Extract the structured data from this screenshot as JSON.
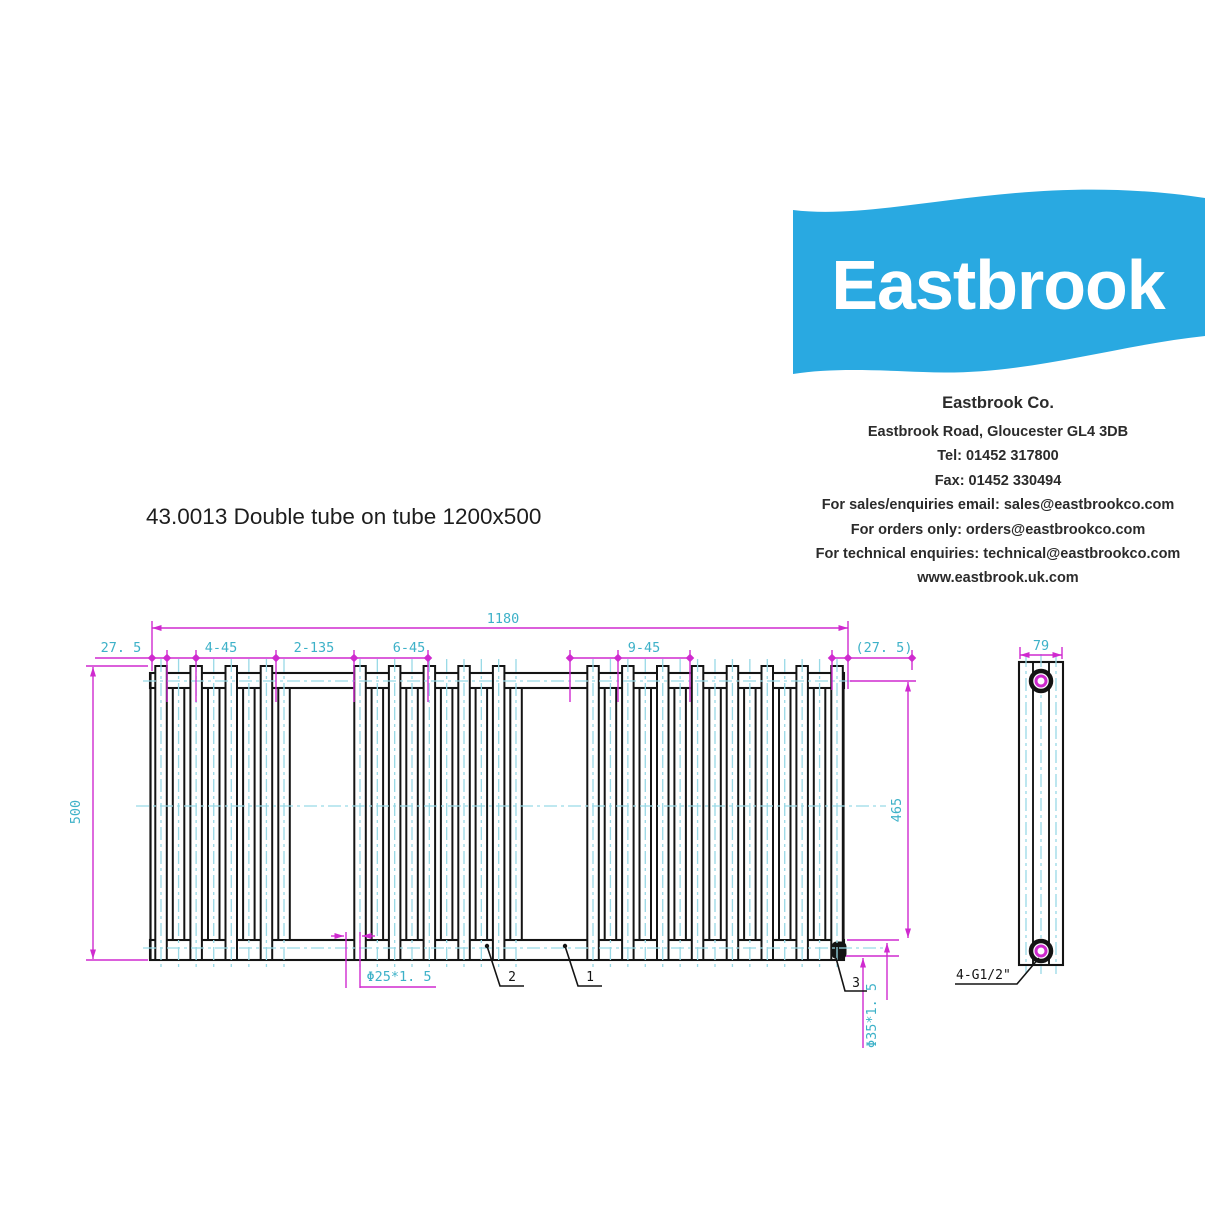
{
  "logo": {
    "text": "Eastbrook",
    "bg_color": "#29a9e1",
    "text_color": "#ffffff"
  },
  "company": {
    "name": "Eastbrook Co.",
    "lines": [
      "Eastbrook Road, Gloucester GL4 3DB",
      "Tel: 01452 317800",
      "Fax: 01452 330494",
      "For sales/enquiries email: sales@eastbrookco.com",
      "For orders only: orders@eastbrookco.com",
      "For technical enquiries: technical@eastbrookco.com",
      "www.eastbrook.uk.com"
    ]
  },
  "product": {
    "title": "43.0013 Double tube on tube  1200x500"
  },
  "drawing": {
    "colors": {
      "outline": "#141414",
      "dimension_line": "#cf2acf",
      "dimension_text": "#3db1c8",
      "centerline": "#99d9e6"
    },
    "dimensions": {
      "overall_width": "1180",
      "left_offset": "27. 5",
      "spacing_1": "4-45",
      "spacing_2": "2-135",
      "spacing_3": "6-45",
      "spacing_4": "9-45",
      "right_offset": "(27. 5)",
      "overall_height": "500",
      "collector_height": "465",
      "depth": "79",
      "tube_size": "Φ25*1. 5",
      "manifold_size": "Φ35*1. 5",
      "connection": "4-G1/2\""
    },
    "part_labels": {
      "part_1": "1",
      "part_2": "2",
      "part_3": "3"
    },
    "front_view": {
      "tube_groups": [
        8,
        10,
        15
      ]
    }
  }
}
